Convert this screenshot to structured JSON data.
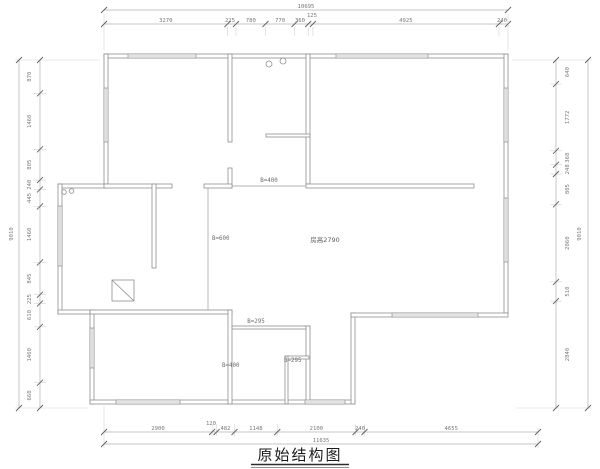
{
  "title": "原始结构图",
  "dims": {
    "top_total": "10695",
    "top_chain": [
      "3270",
      "225",
      "780",
      "770",
      "360",
      "125",
      "4925",
      "240"
    ],
    "bottom_chain": [
      "2900",
      "120",
      "482",
      "1148",
      "2100",
      "240",
      "4655"
    ],
    "bottom_total": "11635",
    "left_total": "9010",
    "left_chain": [
      "870",
      "1460",
      "805",
      "240",
      "445",
      "1460",
      "845",
      "225",
      "610",
      "1460",
      "660"
    ],
    "right_total": "9010",
    "right_chain": [
      "640",
      "1772",
      "368",
      "248",
      "805",
      "2060",
      "510",
      "2840"
    ]
  },
  "annotations": {
    "beam_top": "B=400",
    "beam_mid": "B=600",
    "room_height": "房高2790",
    "step_beam": "B=295",
    "closet_beam": "B=295",
    "bottom_beam": "B=400"
  },
  "colors": {
    "wall_line": "#8f8f8f",
    "dimension_line": "#b0b0b0",
    "dimension_text": "#787878",
    "title_text": "#1c1c1c",
    "background": "#ffffff"
  }
}
